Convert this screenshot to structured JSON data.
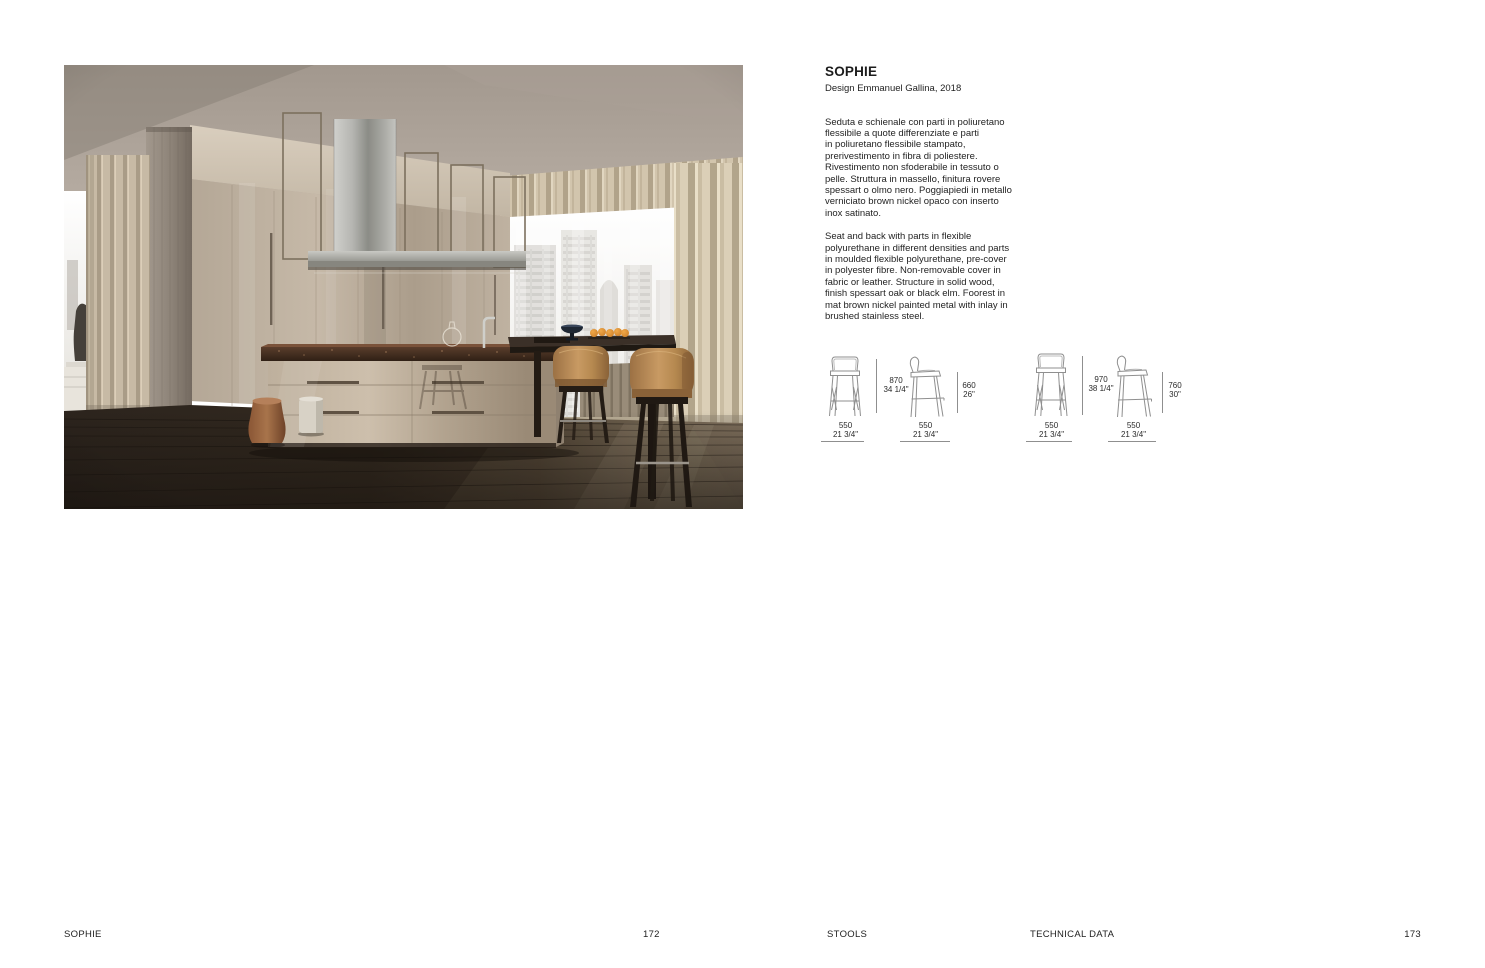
{
  "product": {
    "title": "SOPHIE",
    "designer": "Design Emmanuel Gallina, 2018",
    "description_it": "Seduta e schienale con parti in poliuretano\nflessibile a quote differenziate e parti\nin poliuretano flessibile stampato,\nprerivestimento in fibra di poliestere.\nRivestimento non sfoderabile in tessuto o\npelle. Struttura in massello, finitura rovere\nspessart o olmo nero. Poggiapiedi in metallo\nverniciato brown nickel opaco con inserto\ninox satinato.",
    "description_en": "Seat and back with parts in flexible\npolyurethane in different densities and parts\nin moulded flexible polyurethane, pre-cover\nin polyester fibre. Non-removable cover in\nfabric or leather. Structure in solid wood,\nfinish spessart oak or black elm. Foorest in\nmat brown nickel painted metal with inlay in\nbrushed stainless steel."
  },
  "drawings": {
    "groups": [
      {
        "front": {
          "h_mm": "870",
          "h_in": "34 1/4\"",
          "w_mm": "550",
          "w_in": "21 3/4\""
        },
        "side": {
          "h_mm": "660",
          "h_in": "26\"",
          "w_mm": "550",
          "w_in": "21 3/4\""
        }
      },
      {
        "front": {
          "h_mm": "970",
          "h_in": "38 1/4\"",
          "w_mm": "550",
          "w_in": "21 3/4\""
        },
        "side": {
          "h_mm": "760",
          "h_in": "30\"",
          "w_mm": "550",
          "w_in": "21 3/4\""
        }
      }
    ]
  },
  "footer": {
    "product_name": "SOPHIE",
    "page_left": "172",
    "section_stools": "STOOLS",
    "section_technical": "TECHNICAL DATA",
    "page_right": "173"
  },
  "photo": {
    "palette": {
      "stool_leather": "#b3875a",
      "cabinet_beige": "#bfb2a0",
      "floor_dark": "#30261f",
      "counter_marble": "#3f2a1d",
      "steel": "#a8a8a4",
      "curtain": "#cfc3ab"
    }
  }
}
